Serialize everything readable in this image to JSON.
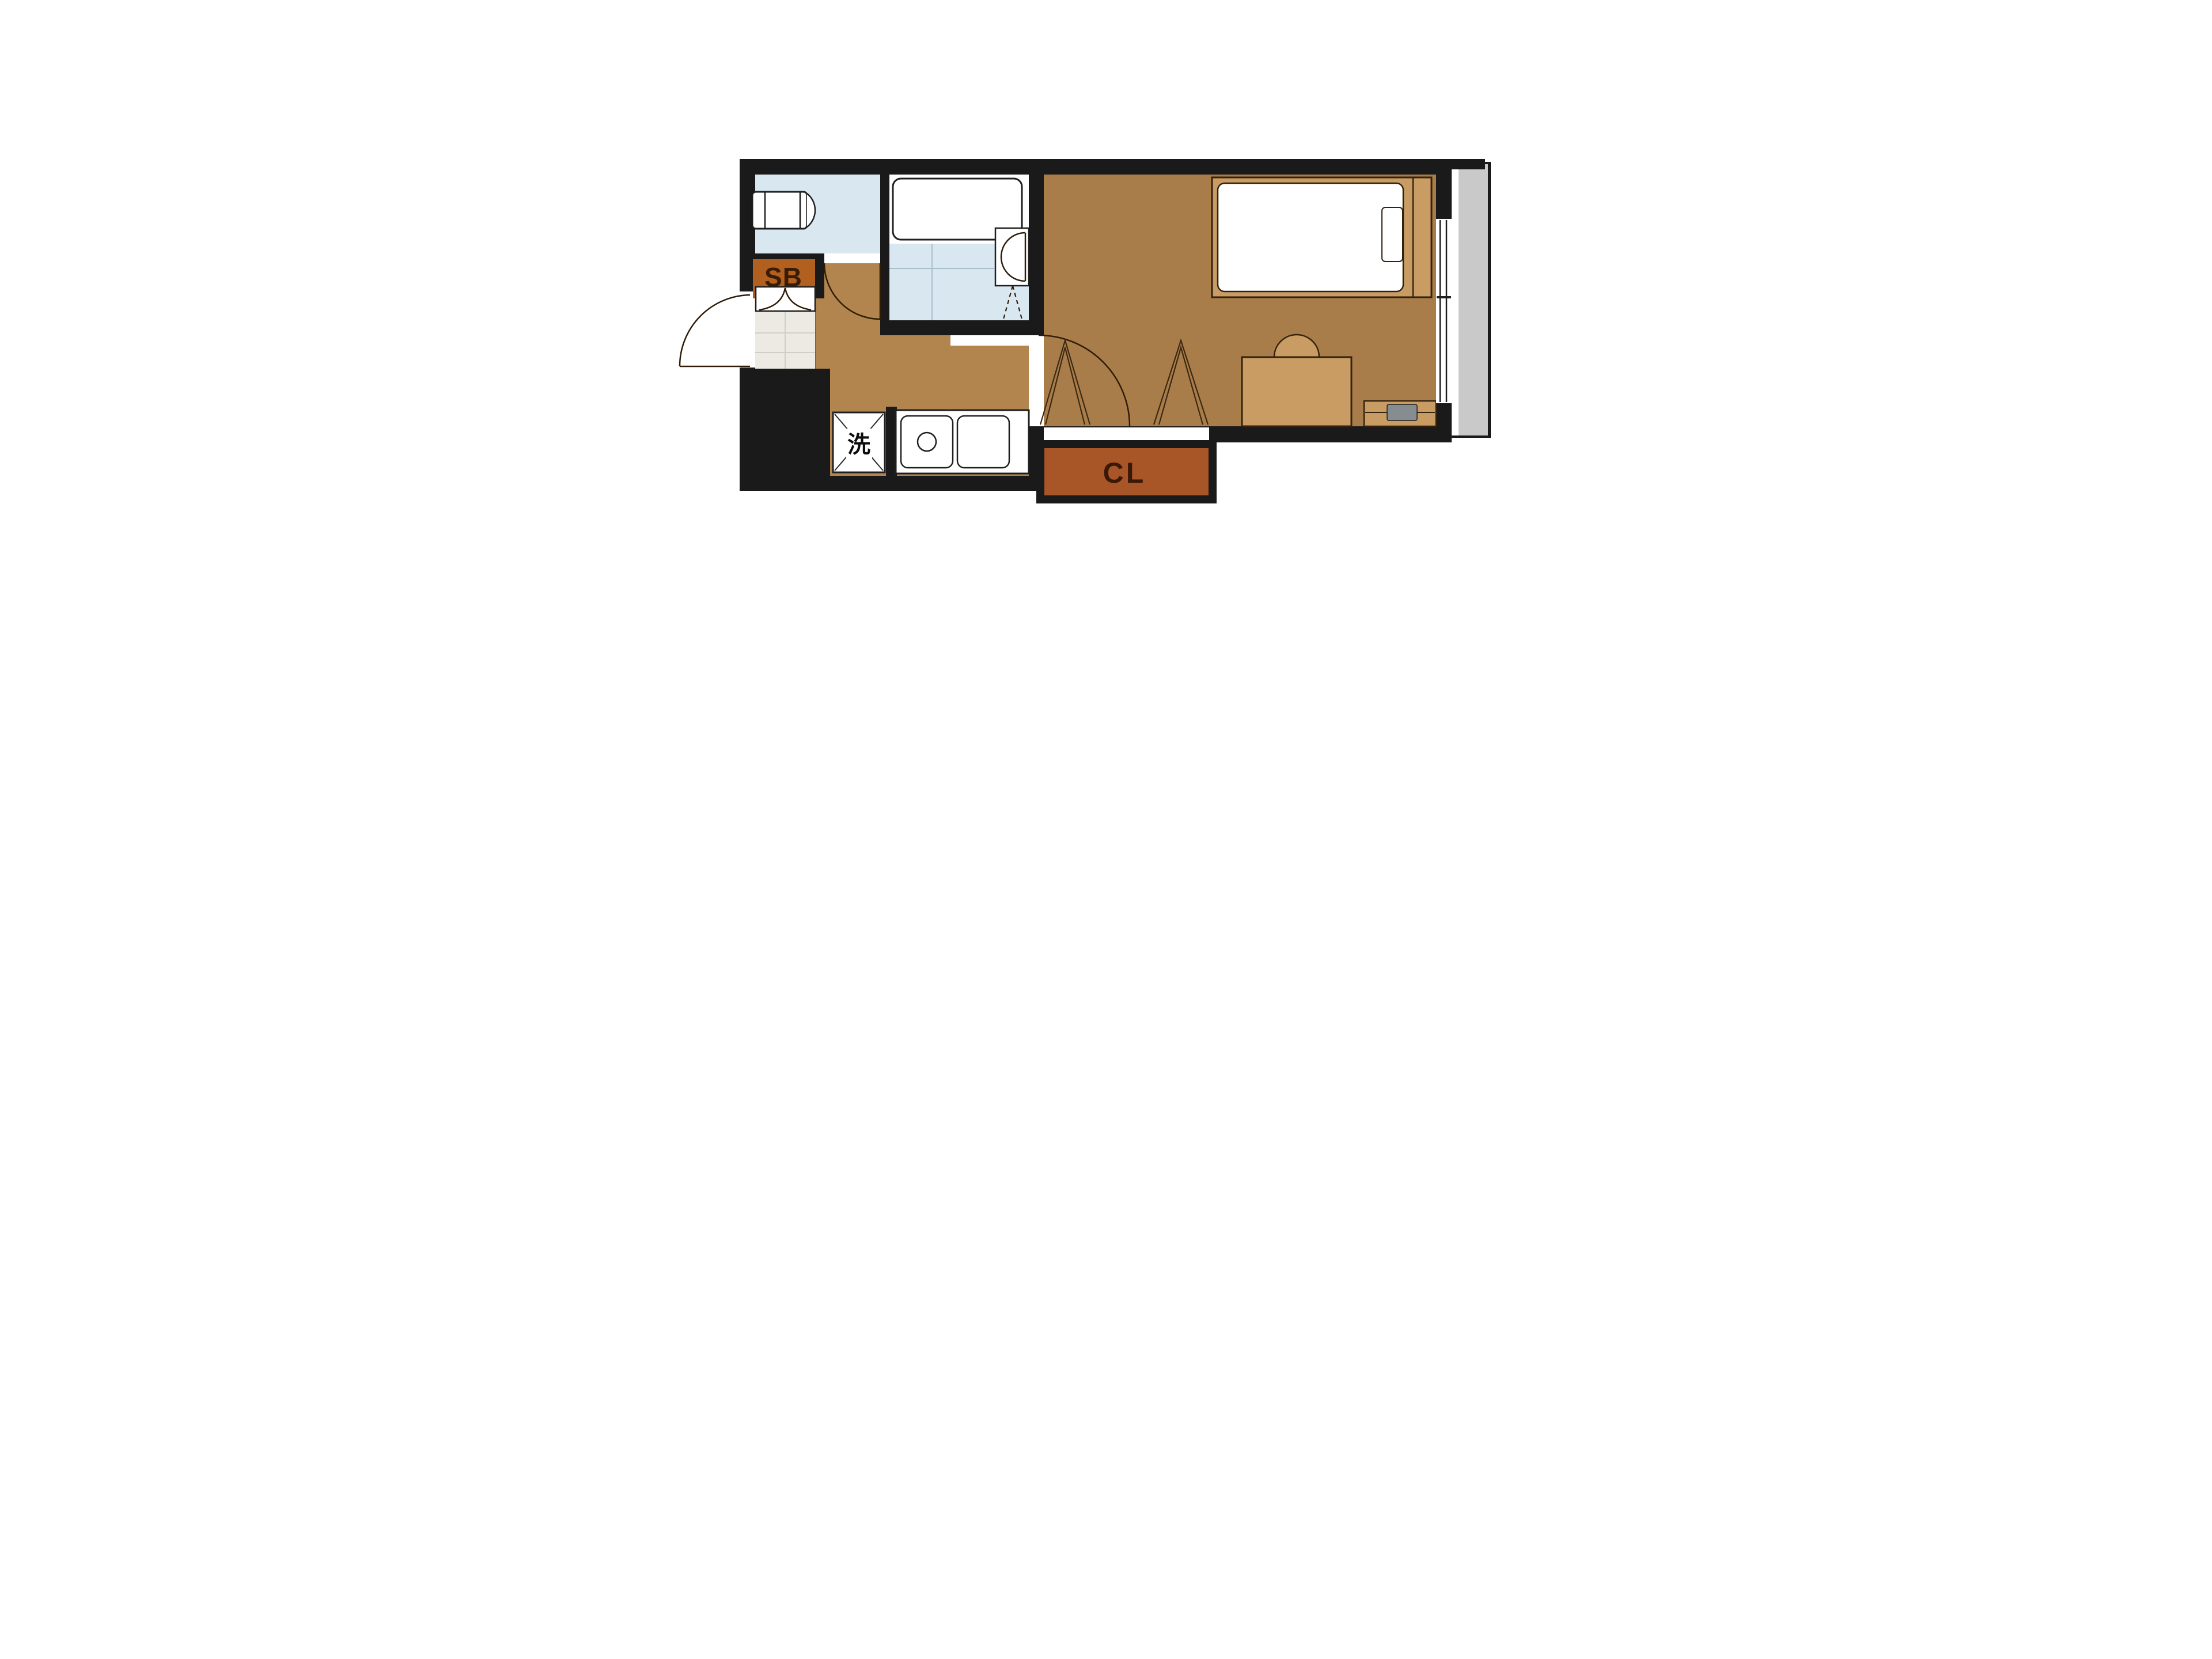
{
  "floor_plan": {
    "title": "studio apartment floor plan",
    "labels": {
      "shoe_box": "SB",
      "closet": "CL",
      "washing_machine": "洗"
    },
    "colors": {
      "wall": "#1a1a1a",
      "wet_area_floor": "#d9e7f0",
      "hallway_floor": "#b2854f",
      "room_floor": "#a97d4a",
      "furniture": "#c89c63",
      "closet_fill": "#a85528",
      "shoe_box_fill": "#b2601f",
      "entrance_tile": "#eceae2",
      "balcony": "#c9c9c9",
      "tv": "#878c91",
      "white": "#ffffff"
    }
  }
}
